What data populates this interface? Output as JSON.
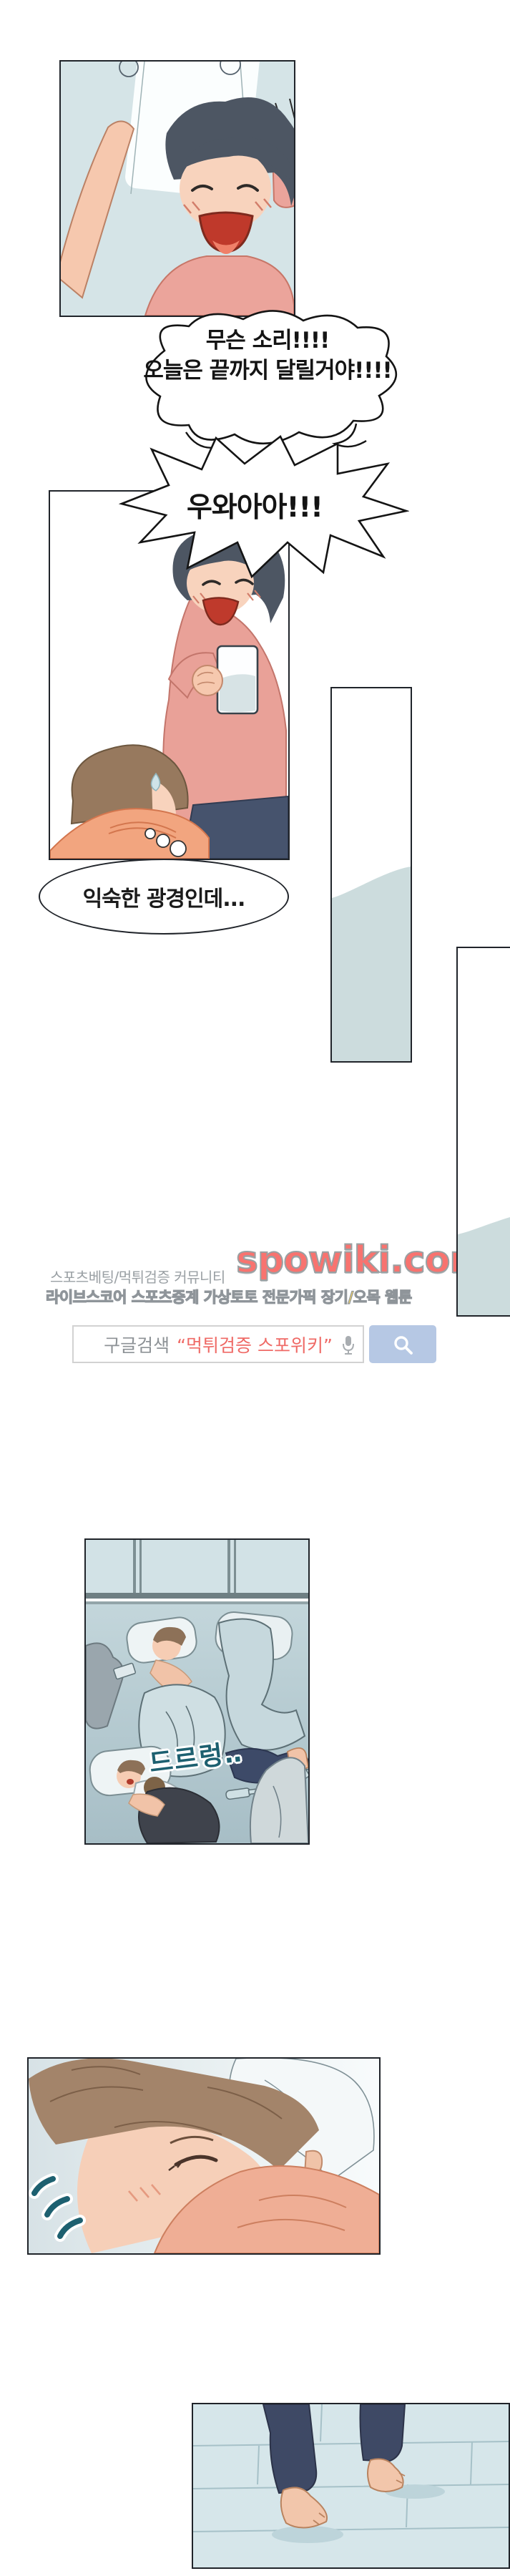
{
  "comic": {
    "bubble1": {
      "line1": "무슨 소리!!!!",
      "line2": "오늘은 끝까지 달릴거야!!!!"
    },
    "bubble2": {
      "text": "우와아아!!!"
    },
    "thought": {
      "text": "익숙한 광경인데..."
    },
    "sfx": {
      "snore": "드르렁‥"
    }
  },
  "ad": {
    "community_label": "스포츠베팅/먹튀검증 커뮤니티",
    "site_name": "spowiki.com",
    "features_line": "라이브스코어 스포츠중계 가상토토 전문가픽 장기/오목 웹툰",
    "search": {
      "prefix": "구글검색",
      "query": "“먹튀검증 스포위키”"
    },
    "colors": {
      "site_red": "#f8736f",
      "features_yellow": "#ffd95c",
      "button_blue": "#b6c8e4",
      "query_red": "#ef6a66"
    }
  }
}
